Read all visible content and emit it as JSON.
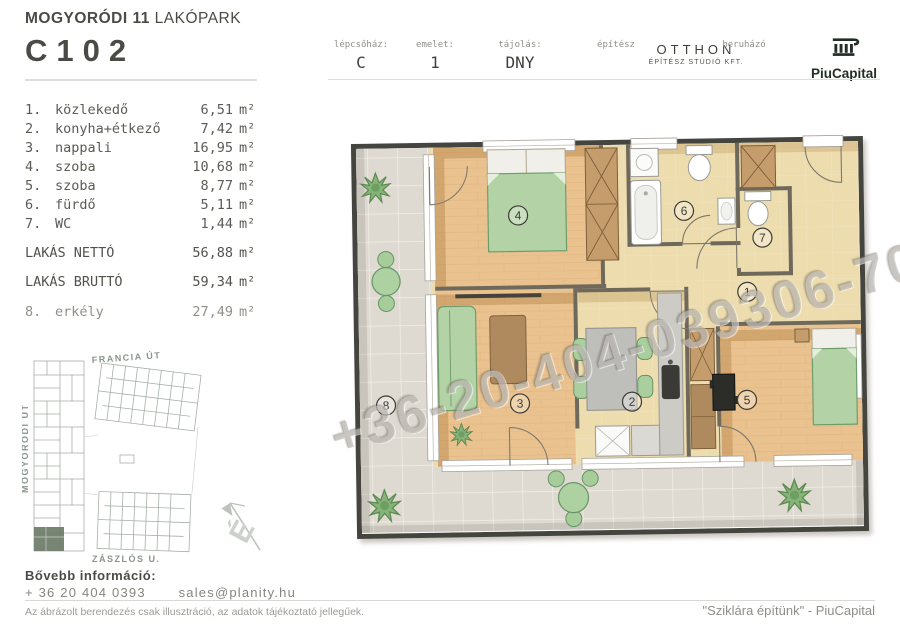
{
  "header": {
    "project": "MOGYORÓDI 11",
    "project_suffix": " LAKÓPARK",
    "unit_id": "C102",
    "fields": [
      {
        "label": "lépcsőház:",
        "value": "C"
      },
      {
        "label": "emelet:",
        "value": "1"
      },
      {
        "label": "tájolás:",
        "value": "DNY"
      },
      {
        "label": "építész",
        "value": "OTTHON",
        "value2": "ÉPÍTÉSZ STÚDIÓ KFT."
      },
      {
        "label": "beruházó",
        "value": "PiuCapital"
      }
    ]
  },
  "rooms": [
    {
      "num": "1.",
      "name": "közlekedő",
      "area": "6,51"
    },
    {
      "num": "2.",
      "name": "konyha+étkező",
      "area": "7,42"
    },
    {
      "num": "3.",
      "name": "nappali",
      "area": "16,95"
    },
    {
      "num": "4.",
      "name": "szoba",
      "area": "10,68"
    },
    {
      "num": "5.",
      "name": "szoba",
      "area": "8,77"
    },
    {
      "num": "6.",
      "name": "fürdő",
      "area": "5,11"
    },
    {
      "num": "7.",
      "name": "WC",
      "area": "1,44"
    }
  ],
  "totals": [
    {
      "label": "LAKÁS NETTÓ",
      "area": "56,88"
    },
    {
      "label": "LAKÁS BRUTTÓ",
      "area": "59,34"
    }
  ],
  "extra": {
    "num": "8.",
    "name": "erkély",
    "area": "27,49"
  },
  "units": {
    "sqm": "m²"
  },
  "site": {
    "streets": [
      "FRANCIA ÚT",
      "MOGYORÓDI ÚT",
      "ZÁSZLÓS U."
    ],
    "north": "É"
  },
  "plan": {
    "labels": [
      "1",
      "2",
      "3",
      "4",
      "5",
      "6",
      "7",
      "8"
    ],
    "watermark": "+36-20-404-039306-70-447"
  },
  "footer": {
    "info_label": "Bővebb információ:",
    "phone": "+ 36 20 404 0393",
    "email": "sales@planity.hu",
    "disclaimer": "Az ábrázolt berendezés csak illusztráció, az adatok tájékoztató jellegűek.",
    "slogan": "\"Sziklára építünk\" - PiuCapital"
  },
  "colors": {
    "accent_green": "#b3d2a5",
    "wood": "#e9c28f",
    "tile": "#ded9d1",
    "beige": "#ecdcae",
    "highlight": "#6d7a68"
  }
}
